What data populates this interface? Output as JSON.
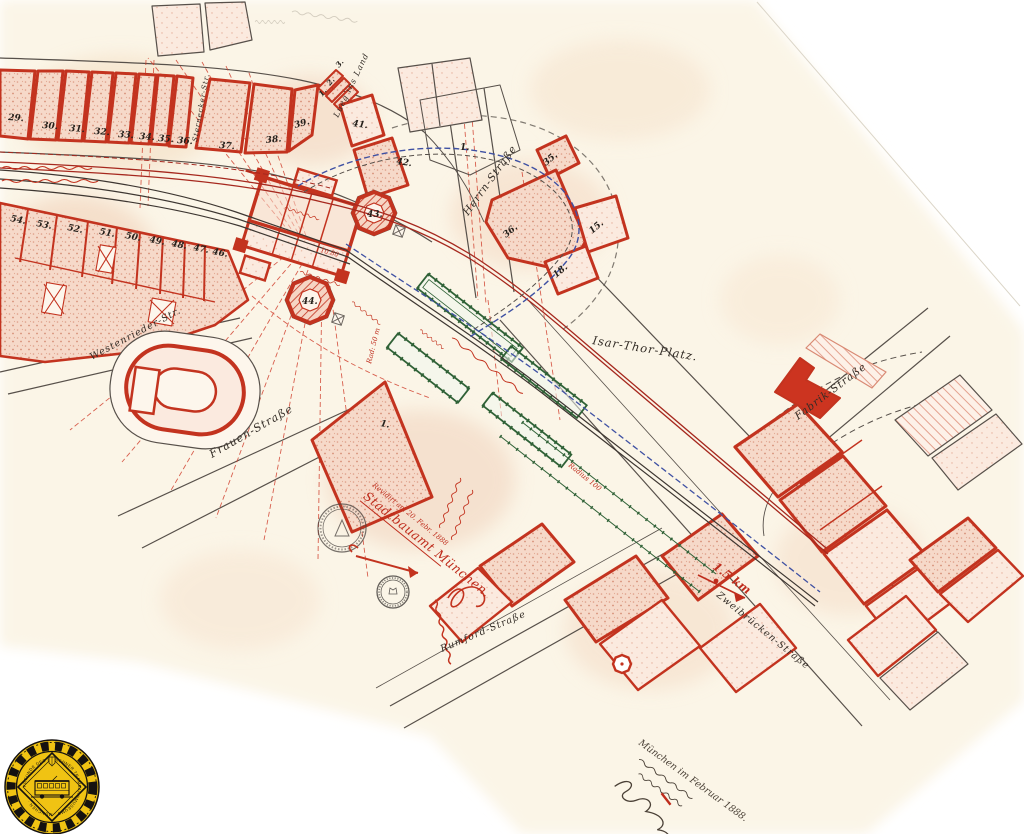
{
  "streets": {
    "isar_thor_platz": "Isar-Thor-Platz.",
    "herrn": "Herrn-Straße",
    "fabrik": "Fabrik-Straße",
    "frauen": "Frauen-Straße",
    "westenrieder": "Westenrieder-Str.",
    "zweibruecken": "Zweibrücken-Straße",
    "rumford": "Rumford-Straße",
    "lueg_ins_land": "Lueg ins Land",
    "sternecker": "Sternecker-Str."
  },
  "parcels": {
    "top_row": [
      "29.",
      "30.",
      "31.",
      "32.",
      "33.",
      "34.",
      "35.",
      "36.",
      "37.",
      "38.",
      "39."
    ],
    "corner_row": [
      "1.",
      "2.",
      "3."
    ],
    "left_row": [
      "54.",
      "53.",
      "52.",
      "51.",
      "50.",
      "49.",
      "48.",
      "47.",
      "46."
    ],
    "center_41": "41.",
    "center_42": "42.",
    "center_1": "1.",
    "octagon_north": "43.",
    "octagon_south": "44.",
    "east_35": "35.",
    "east_36": "36.",
    "east_15": "15.",
    "east_18": "18.",
    "south_1": "1."
  },
  "annotations": {
    "radius_small": "Rad: 50 m",
    "radius_large": "Radius 100",
    "distance": "1.5 km",
    "dim_note": "10.80",
    "revision_line1": "Revidirt am 20. Febr. 1888",
    "revision_line2": "Stadtbauamt München.",
    "date_line": "München im Februar 1888."
  },
  "logo": {
    "org": "FREUNDE DES MÜNCHNER TRAMBAHNMUSEUMS · MÜNCHEN ·"
  }
}
